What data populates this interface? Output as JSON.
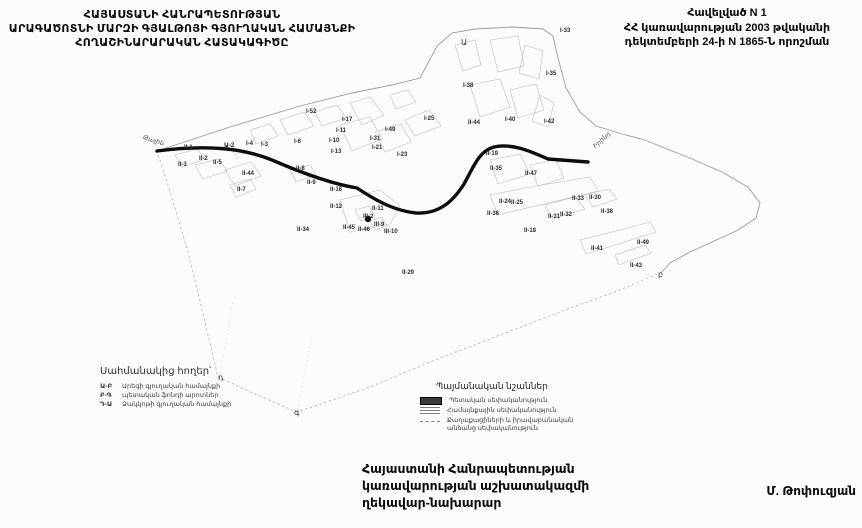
{
  "header": {
    "title_lines": [
      "ՀԱՅԱՍՏԱՆԻ ՀԱՆՐԱՊԵՏՈՒԹՅԱՆ",
      "ԱՐԱԳԱԾՈՏՆԻ ՄԱՐԶԻ ԳՅԱԼԹՈՅԻ ԳՅՈՒՂԱԿԱՆ ՀԱՄԱՅՆՔԻ",
      "ՀՈՂԱՇԻՆԱՐԱՐԱԿԱՆ ՀԱՏԱԿԱԳԻԾԸ"
    ]
  },
  "annex": {
    "lines": [
      "Հավելված N 1",
      "ՀՀ կառավարության 2003 թվականի",
      "դեկտեմբերի 24-ի N 1865-Ն որոշման"
    ]
  },
  "map": {
    "parcel_labels": [
      {
        "text": "I-33",
        "x": 560,
        "y": 28
      },
      {
        "text": "I-35",
        "x": 546,
        "y": 71
      },
      {
        "text": "I-38",
        "x": 463,
        "y": 83
      },
      {
        "text": "I-40",
        "x": 505,
        "y": 117
      },
      {
        "text": "I-42",
        "x": 544,
        "y": 119
      },
      {
        "text": "II-44",
        "x": 468,
        "y": 120
      },
      {
        "text": "I-25",
        "x": 424,
        "y": 116
      },
      {
        "text": "I-52",
        "x": 306,
        "y": 109
      },
      {
        "text": "I-17",
        "x": 342,
        "y": 117
      },
      {
        "text": "I-11",
        "x": 336,
        "y": 128
      },
      {
        "text": "I-10",
        "x": 329,
        "y": 138
      },
      {
        "text": "I-13",
        "x": 331,
        "y": 149
      },
      {
        "text": "I-49",
        "x": 385,
        "y": 127
      },
      {
        "text": "I-31",
        "x": 370,
        "y": 136
      },
      {
        "text": "I-21",
        "x": 372,
        "y": 145
      },
      {
        "text": "I-23",
        "x": 397,
        "y": 152
      },
      {
        "text": "I-4",
        "x": 246,
        "y": 141
      },
      {
        "text": "I-3",
        "x": 261,
        "y": 142
      },
      {
        "text": "I-6",
        "x": 294,
        "y": 139
      },
      {
        "text": "II-1",
        "x": 184,
        "y": 145
      },
      {
        "text": "Ա-2",
        "x": 224,
        "y": 142
      },
      {
        "text": "II-2",
        "x": 199,
        "y": 156
      },
      {
        "text": "II-3",
        "x": 178,
        "y": 162
      },
      {
        "text": "II-5",
        "x": 213,
        "y": 160
      },
      {
        "text": "II-44",
        "x": 242,
        "y": 171
      },
      {
        "text": "II-7",
        "x": 237,
        "y": 187
      },
      {
        "text": "II-8",
        "x": 296,
        "y": 166
      },
      {
        "text": "II-9",
        "x": 307,
        "y": 180
      },
      {
        "text": "II-34",
        "x": 297,
        "y": 227
      },
      {
        "text": "II-16",
        "x": 330,
        "y": 187
      },
      {
        "text": "II-12",
        "x": 330,
        "y": 204
      },
      {
        "text": "II-45",
        "x": 343,
        "y": 225
      },
      {
        "text": "II-46",
        "x": 358,
        "y": 227
      },
      {
        "text": "III-2",
        "x": 363,
        "y": 214
      },
      {
        "text": "III-9",
        "x": 374,
        "y": 222
      },
      {
        "text": "III-10",
        "x": 384,
        "y": 229
      },
      {
        "text": "II-11",
        "x": 372,
        "y": 206
      },
      {
        "text": "II-29",
        "x": 402,
        "y": 270
      },
      {
        "text": "II-19",
        "x": 486,
        "y": 151
      },
      {
        "text": "II-35",
        "x": 490,
        "y": 166
      },
      {
        "text": "II-47",
        "x": 525,
        "y": 171
      },
      {
        "text": "II-24",
        "x": 499,
        "y": 199
      },
      {
        "text": "II-25",
        "x": 511,
        "y": 200
      },
      {
        "text": "II-36",
        "x": 487,
        "y": 211
      },
      {
        "text": "II-18",
        "x": 524,
        "y": 228
      },
      {
        "text": "II-33",
        "x": 572,
        "y": 196
      },
      {
        "text": "II-30",
        "x": 589,
        "y": 195
      },
      {
        "text": "II-31",
        "x": 548,
        "y": 214
      },
      {
        "text": "II-32",
        "x": 560,
        "y": 212
      },
      {
        "text": "II-38",
        "x": 601,
        "y": 209
      },
      {
        "text": "II-41",
        "x": 591,
        "y": 246
      },
      {
        "text": "II-49",
        "x": 637,
        "y": 240
      },
      {
        "text": "II-43",
        "x": 630,
        "y": 263
      }
    ],
    "boundary_letters": [
      {
        "text": "Ա",
        "x": 461,
        "y": 38
      },
      {
        "text": "բ",
        "x": 658,
        "y": 270
      },
      {
        "text": "գ",
        "x": 294,
        "y": 408
      },
      {
        "text": "դ",
        "x": 218,
        "y": 373
      }
    ],
    "road_labels": [
      {
        "text": "Թալին",
        "x": 143,
        "y": 133,
        "rotate": 18
      },
      {
        "text": "Իրինդ",
        "x": 594,
        "y": 143,
        "rotate": -42
      }
    ]
  },
  "adjacent_lands_legend": {
    "title": "Սահմանակից հողեր՝",
    "items": [
      {
        "code": "Ա-Բ",
        "label": "Արեգի գյուղական համայնքի"
      },
      {
        "code": "Բ-Գ",
        "label": "պետական ֆոնդի արոտներ"
      },
      {
        "code": "Դ-Ա",
        "label": "Ձակկոթի գյուղական համայնքի"
      }
    ]
  },
  "symbols_legend": {
    "title": "Պայմանական նշաններ",
    "items": [
      {
        "swatch": "solid",
        "label": "Պետական սեփականություն"
      },
      {
        "swatch": "hatch",
        "label": "Համայնքային սեփականություն"
      },
      {
        "swatch": "dash",
        "label": "Քաղաքացիների և իրավաբանական անձանց սեփականություն"
      }
    ]
  },
  "footer": {
    "lines": [
      "Հայաստանի Հանրապետության",
      "կառավարության աշխատակազմի",
      "ղեկավար-նախարար"
    ],
    "signature": "Մ. Թոփուզյան"
  },
  "colors": {
    "paper": "#fcfcfa",
    "ink": "#111111",
    "map_line": "#b5b5b5",
    "road": "#0d0d0d"
  }
}
